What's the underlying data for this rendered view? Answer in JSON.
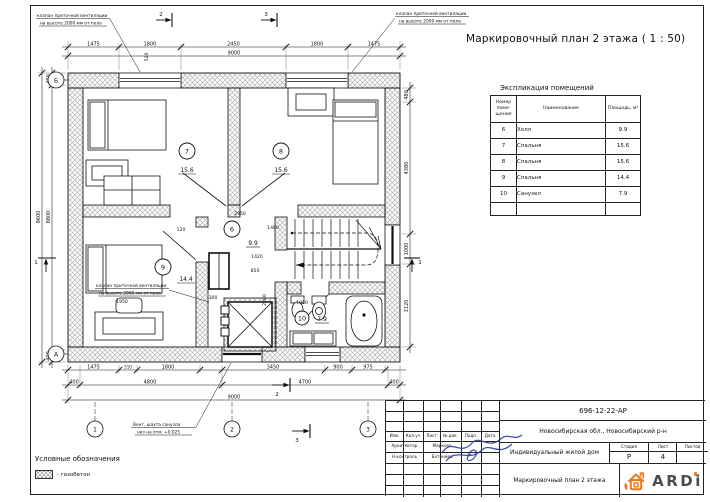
{
  "sheet": {
    "title": "Маркировочный план 2 этажа ( 1 : 50)"
  },
  "colors": {
    "logo_orange": "#e8791d",
    "signature_blue": "#2b3f9e",
    "line": "#1a1a1a"
  },
  "plan": {
    "rooms": [
      {
        "num": "7",
        "area": "15.6"
      },
      {
        "num": "8",
        "area": "15.6"
      },
      {
        "num": "9",
        "area": "14.4"
      },
      {
        "num": "6",
        "area": "9.9"
      },
      {
        "num": "10",
        "area": "7.9"
      }
    ],
    "axes": {
      "b": "Б",
      "a": "А",
      "n1": "1",
      "n2": "2",
      "n3": "3"
    },
    "sections": {
      "top2": "2",
      "top3": "3",
      "bot2": "2",
      "bot3": "3",
      "left1": "1",
      "right1": "1"
    },
    "annotations": {
      "valve1": "клапан приточной вентиляции",
      "valve2": "на высоте 2000 мм от пола",
      "shaft1": "Вент. шахта санузла",
      "shaft2": "низ на отм. +0,025"
    },
    "dims": {
      "top": [
        "1475",
        "1800",
        "2450",
        "1800",
        "1475"
      ],
      "top_overall": "9000",
      "left": [
        "400",
        "8800",
        "400"
      ],
      "left_overall": "9600",
      "right": [
        "480",
        "4380",
        "1000",
        "3120"
      ],
      "bottom1": [
        "1475",
        "510",
        "1800",
        "3450",
        "900",
        "975"
      ],
      "bottom2": [
        "400",
        "4800",
        "4700",
        "400"
      ],
      "bottom_overall": "9000",
      "inner": [
        "2950",
        "1480",
        "1420",
        "850",
        "2780",
        "1950",
        "1950",
        "300",
        "120",
        "520"
      ]
    }
  },
  "schedule": {
    "title": "Экспликация помещений",
    "headers": {
      "number_lines": [
        "Номер",
        "поме-",
        "щения"
      ],
      "name": "Наименование",
      "area": "Площадь, м²"
    },
    "rows": [
      {
        "number": "6",
        "name": "Холл",
        "area": "9.9"
      },
      {
        "number": "7",
        "name": "Спальня",
        "area": "15.6"
      },
      {
        "number": "8",
        "name": "Спальня",
        "area": "15.6"
      },
      {
        "number": "9",
        "name": "Спальня",
        "area": "14.4"
      },
      {
        "number": "10",
        "name": "Санузел",
        "area": "7.9"
      }
    ]
  },
  "legend": {
    "title": "Условные обозначения",
    "item": "- газобетон"
  },
  "titleblock": {
    "doc_number": "696-12-22-АР",
    "location": "Новосибирская обл., Новосибирский р-н",
    "object": "Индивидуальный жилой дом",
    "sheet_name": "Маркировочный план 2 этажа",
    "stage_label": "Стадия",
    "stage": "Р",
    "sheet_label": "Лист",
    "sheet_no": "4",
    "sheets_label": "Листов",
    "cols": [
      "Изм.",
      "Кол.уч",
      "Лист",
      "№ док.",
      "Подп.",
      "Дата"
    ],
    "roles": [
      {
        "role": "Архитектор",
        "name": "Маркова"
      },
      {
        "role": "Н.контроль",
        "name": "Батенева"
      }
    ],
    "logo": "ARDi"
  }
}
